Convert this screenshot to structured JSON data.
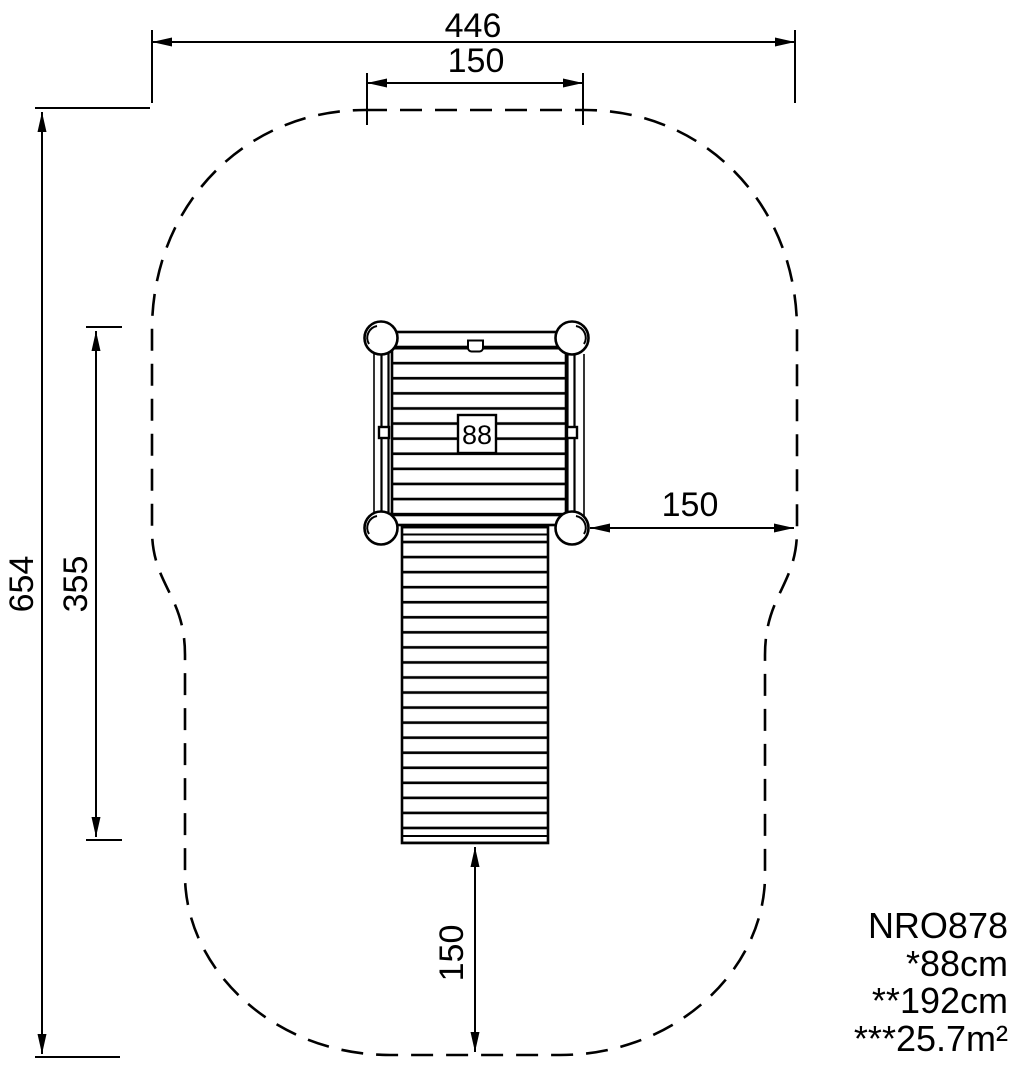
{
  "drawing": {
    "dims": {
      "total_width": "446",
      "tower_width": "150",
      "total_depth": "654",
      "equipment_depth": "355",
      "side_clearance": "150",
      "front_clearance": "150"
    },
    "platform_label": "88",
    "notes": [
      "NRO878",
      "*88cm",
      "**192cm",
      "***25.7m²"
    ],
    "colors": {
      "ink": "#000000",
      "paper": "#ffffff"
    }
  }
}
